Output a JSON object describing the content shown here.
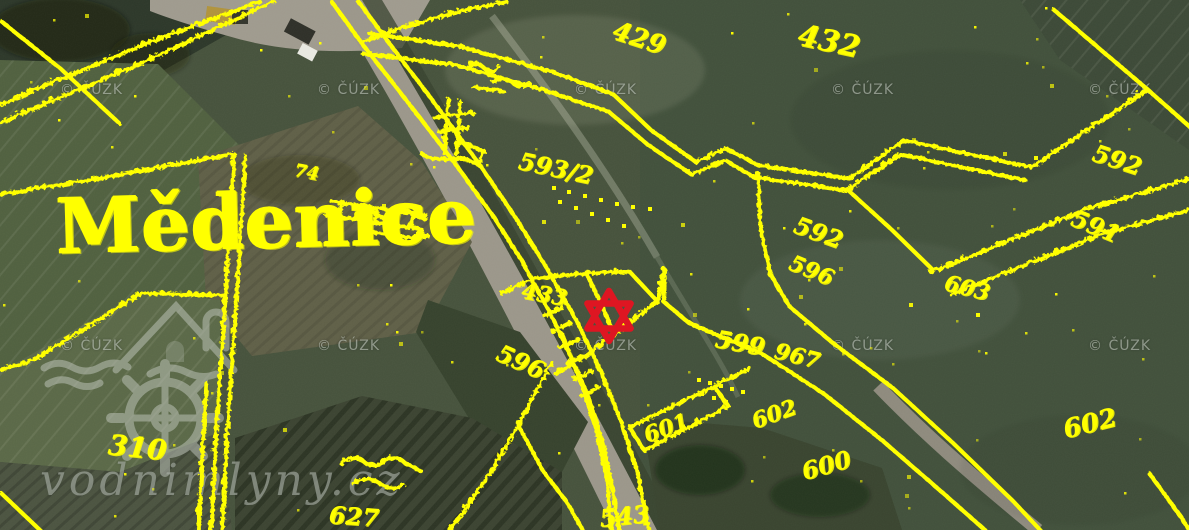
{
  "map": {
    "place_label": "Mědenice",
    "line_color": "#ffff00",
    "marker": {
      "name": "selected-site-star",
      "shape": "six-pointed-star-outline",
      "color": "#de1622"
    }
  },
  "watermarks": {
    "cuzk_label": "© ČÚZK",
    "site_label": "vodnimlyny.cz"
  },
  "parcels": [
    {
      "text": "429"
    },
    {
      "text": "432"
    },
    {
      "text": "593/2"
    },
    {
      "text": "592"
    },
    {
      "text": "596"
    },
    {
      "text": "592"
    },
    {
      "text": "591"
    },
    {
      "text": "603"
    },
    {
      "text": "433"
    },
    {
      "text": "599"
    },
    {
      "text": "967"
    },
    {
      "text": "596"
    },
    {
      "text": "601"
    },
    {
      "text": "602"
    },
    {
      "text": "600"
    },
    {
      "text": "602"
    },
    {
      "text": "543"
    },
    {
      "text": "627"
    },
    {
      "text": "310"
    },
    {
      "text": "74"
    }
  ]
}
